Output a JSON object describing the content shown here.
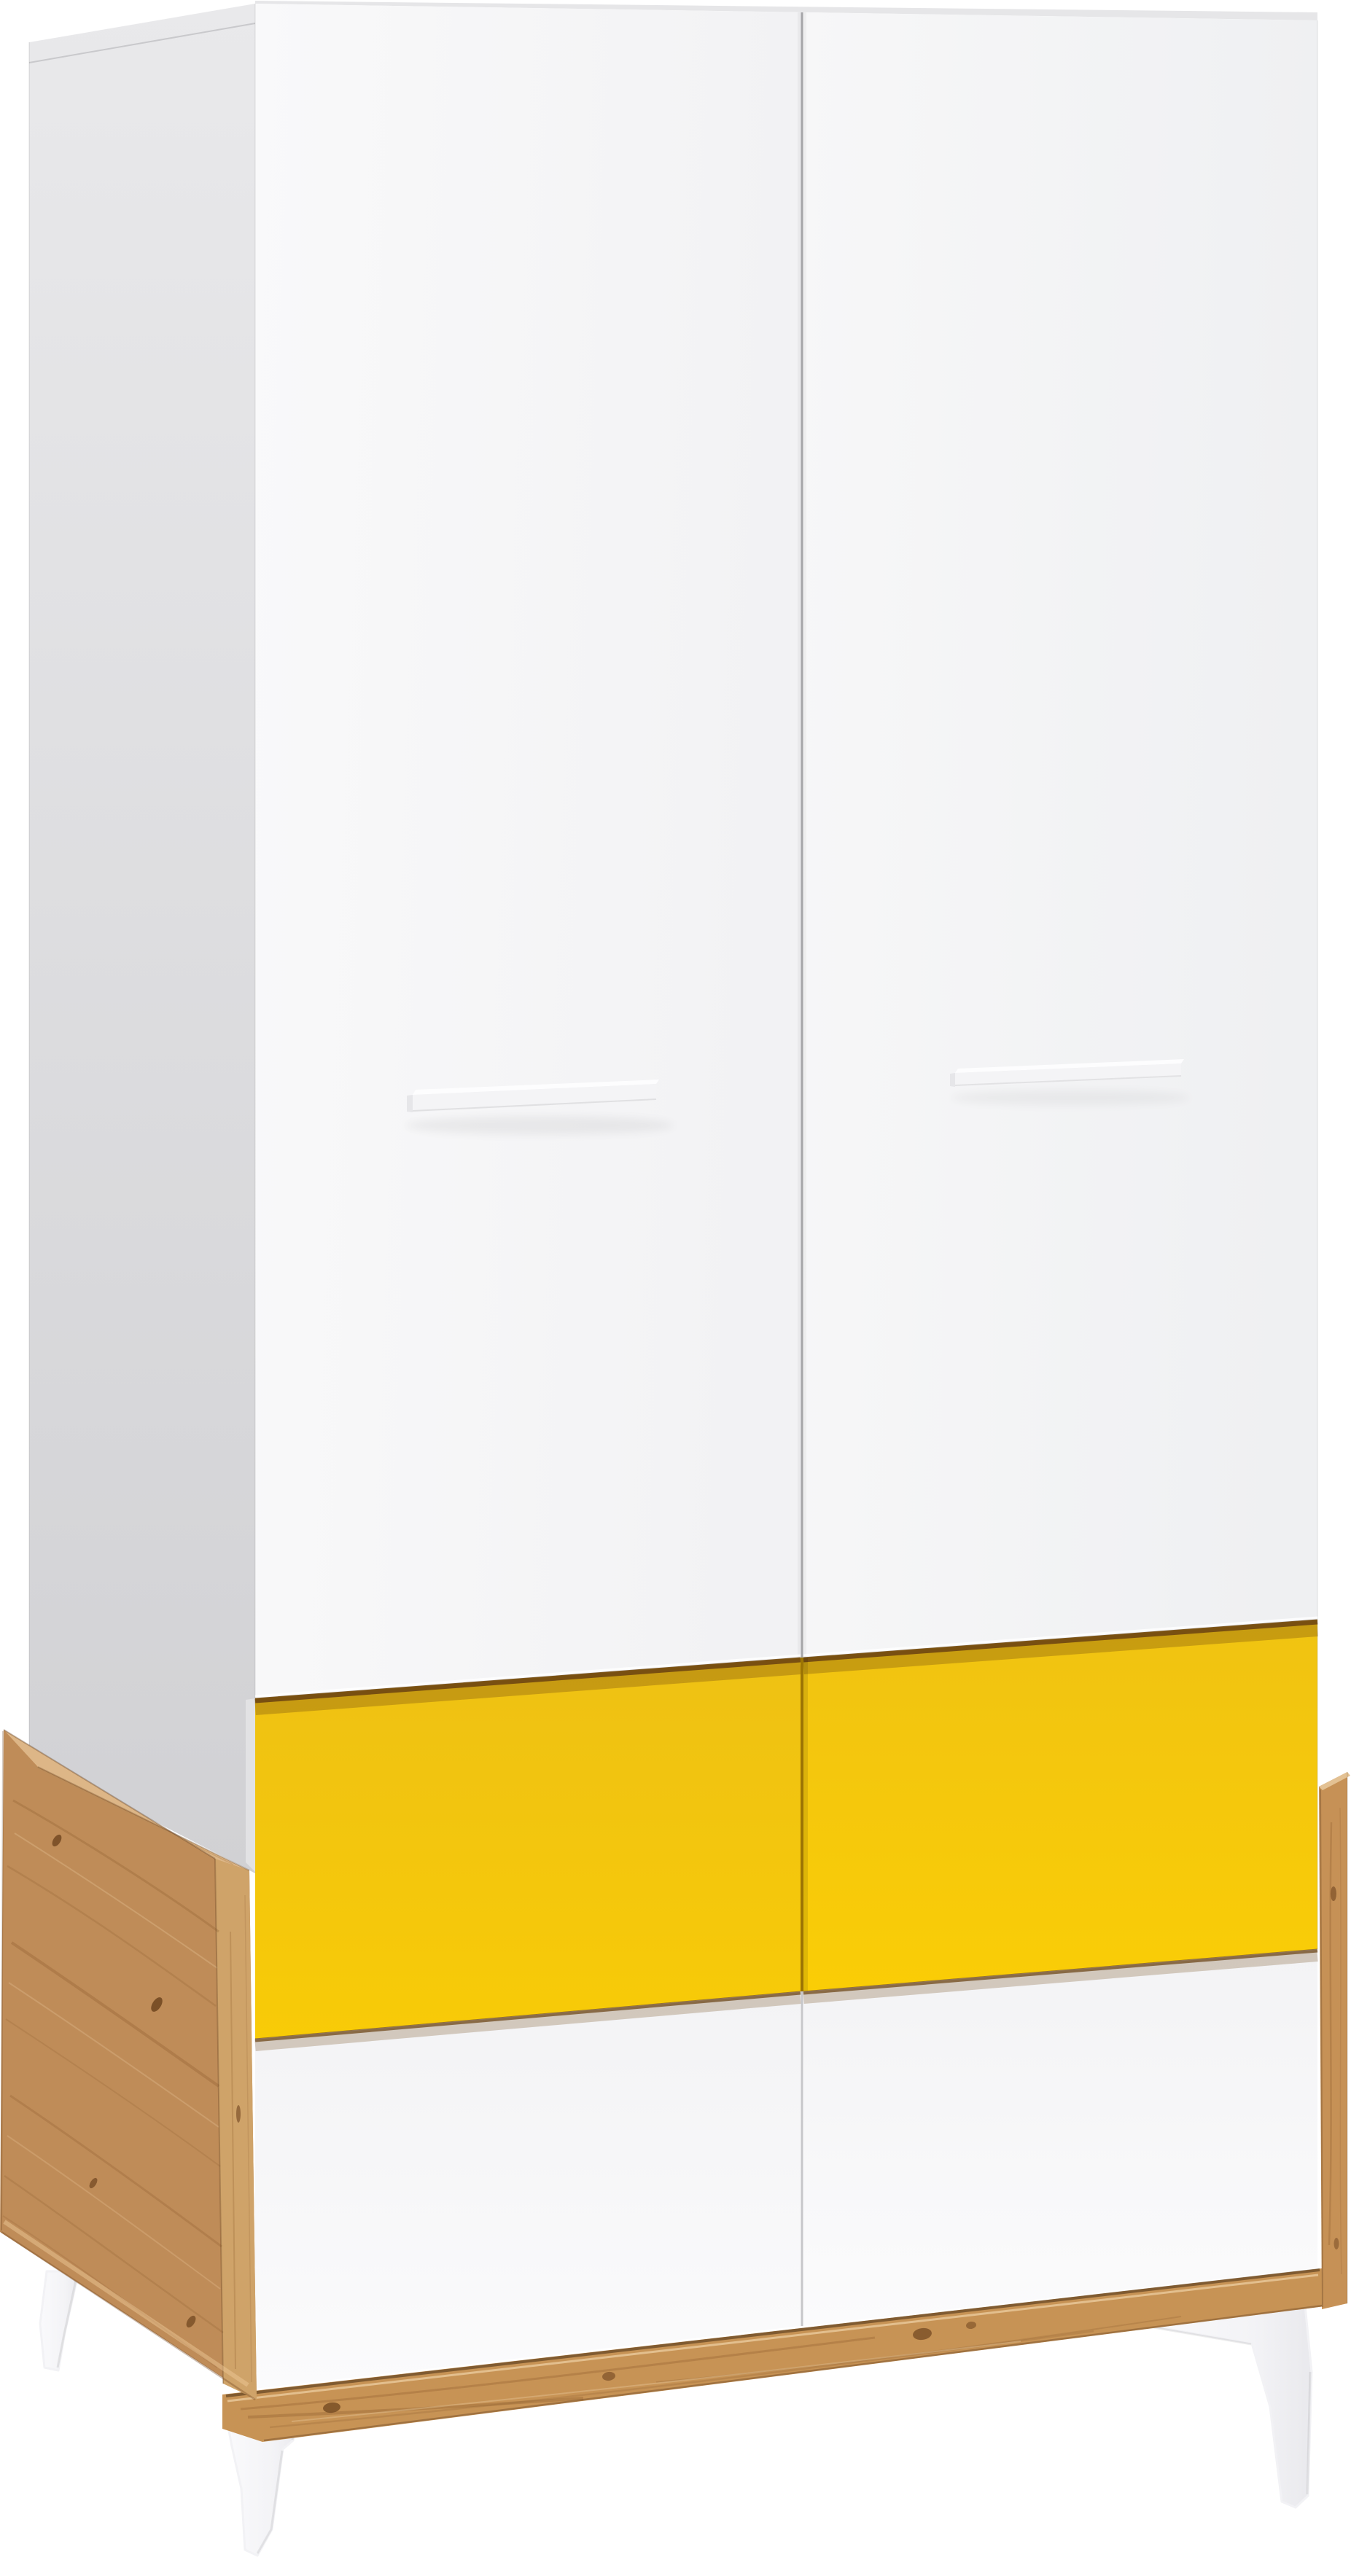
{
  "image": {
    "description": "Studio product photo of a tall two-door wardrobe, white fronts with bar handles, a yellow drawer row and a white drawer row set into an artisan-oak base with angled white legs, shot from the front-left on a pure white background",
    "background": "#ffffff"
  },
  "colors": {
    "background": "#ffffff",
    "side_panel_top": "#e9e9eb",
    "side_panel_bottom": "#d1d1d4",
    "top_edge_sliver": "#e6e6e8",
    "door_light": "#f9f9fa",
    "door_shade": "#f2f2f4",
    "door_right_light": "#f7f7f8",
    "door_right_shade": "#eff0f2",
    "door_gap": "#a5a5a8",
    "handle_face": "#f4f4f6",
    "handle_top": "#fdfdfe",
    "handle_cap": "#e6e6e9",
    "drawer_yellow_top": "#eec114",
    "drawer_yellow_bottom": "#f8cb07",
    "drawer_white_top": "#f3f3f5",
    "drawer_white_bottom": "#fbfbfc",
    "recess_shadow": "#6a4212",
    "yellow_seam": "#9c7404",
    "white_seam": "#c6c6c9",
    "oak_face": "#bf8c58",
    "oak_chamfer": "#ddb687",
    "oak_front_edge": "#cfa369",
    "oak_plinth": "#c79355",
    "oak_right_edge": "#c69156",
    "oak_right_top": "#e3c193",
    "oak_grain": "#8a5a2c",
    "oak_knot": "#6f451f",
    "leg_light": "#fafafc",
    "leg_dark": "#e9e9ed"
  }
}
